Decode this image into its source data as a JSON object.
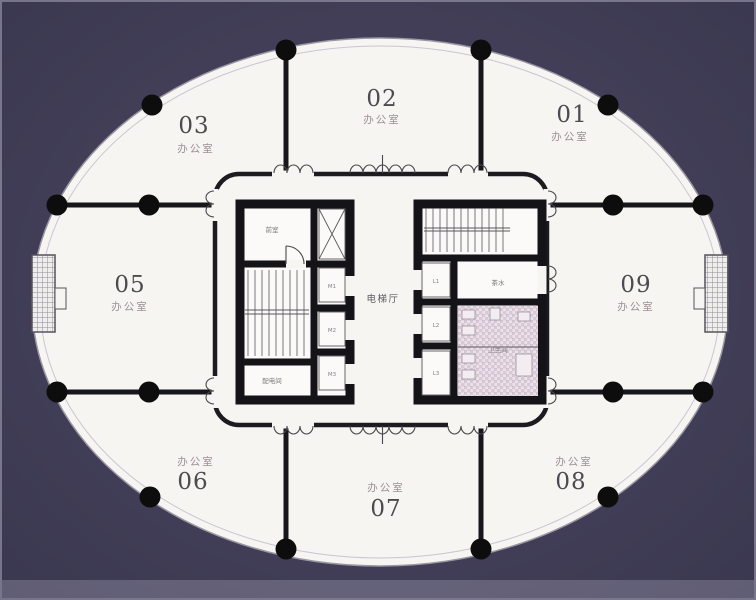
{
  "colors": {
    "background": "#433f58",
    "floor": "#f6f5f2",
    "wall": "#17161a",
    "tile": "#d9c9d7"
  },
  "floor_plan": {
    "rooms": [
      {
        "num": "01",
        "type": "办公室"
      },
      {
        "num": "02",
        "type": "办公室"
      },
      {
        "num": "03",
        "type": "办公室"
      },
      {
        "num": "05",
        "type": "办公室"
      },
      {
        "num": "06",
        "type": "办公室"
      },
      {
        "num": "07",
        "type": "办公室"
      },
      {
        "num": "08",
        "type": "办公室"
      },
      {
        "num": "09",
        "type": "办公室"
      }
    ],
    "core": {
      "elevator_hall": "电梯厅",
      "anteroom": "前室",
      "power_room": "配电间",
      "pantry": "茶水",
      "toilet": "卫生间",
      "lifts_left": [
        "M1",
        "M2",
        "M3"
      ],
      "lifts_right": [
        "L1",
        "L2",
        "L3"
      ]
    }
  }
}
